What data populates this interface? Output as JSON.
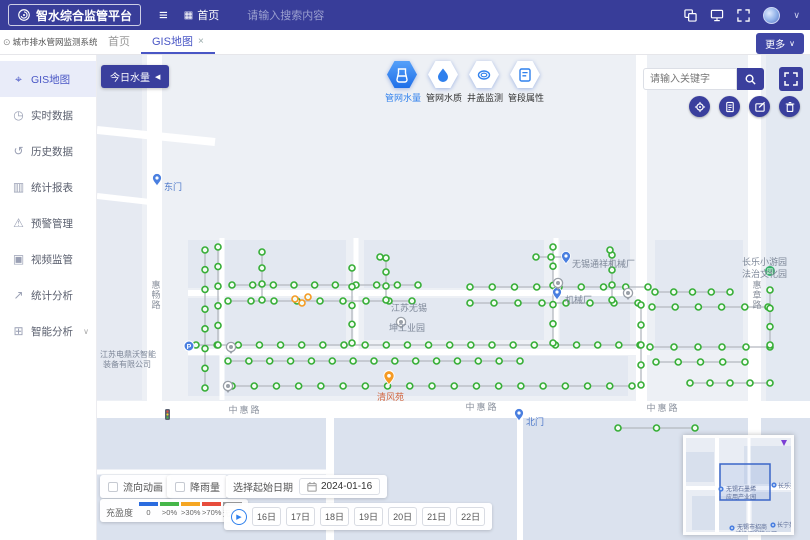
{
  "colors": {
    "header_bg": "#383d99",
    "indigo": "#3a3f9d",
    "accent_blue": "#2f80ed",
    "node_green": "#36ae36",
    "orange": "#f59a23",
    "road_label": "#8b929e"
  },
  "icons": {
    "hamburger": "≡",
    "home_grid": "▦",
    "chevron_down": "∨",
    "collapse_up": "^",
    "close": "×",
    "play": "▶",
    "back_arrow": "◀",
    "info": "⊙",
    "expand_down": "∨"
  },
  "header": {
    "logo_text": "智水综合监管平台",
    "home_label": "首页",
    "search_placeholder": "请输入搜索内容"
  },
  "tabbar": {
    "system_title": "城市排水管网监测系统",
    "tabs": [
      {
        "label": "首页",
        "active": false,
        "closable": false
      },
      {
        "label": "GIS地图",
        "active": true,
        "closable": true
      }
    ],
    "more_label": "更多"
  },
  "sidebar": {
    "items": [
      {
        "glyph": "⌖",
        "icon": "gis-map-icon",
        "label": "GIS地图",
        "active": true
      },
      {
        "glyph": "◷",
        "icon": "clock-icon",
        "label": "实时数据"
      },
      {
        "glyph": "↺",
        "icon": "history-icon",
        "label": "历史数据"
      },
      {
        "glyph": "▥",
        "icon": "report-icon",
        "label": "统计报表"
      },
      {
        "glyph": "⚠",
        "icon": "alert-icon",
        "label": "预警管理"
      },
      {
        "glyph": "▣",
        "icon": "video-icon",
        "label": "视频监管"
      },
      {
        "glyph": "↗",
        "icon": "trend-icon",
        "label": "统计分析"
      },
      {
        "glyph": "⊞",
        "icon": "ai-icon",
        "label": "智能分析",
        "expandable": true
      }
    ]
  },
  "map_toolbar": {
    "today_button": "今日水量",
    "layers": [
      {
        "icon": "beaker",
        "label": "管网水量",
        "active": true
      },
      {
        "icon": "droplet",
        "label": "管网水质",
        "active": false
      },
      {
        "icon": "manhole",
        "label": "井盖监测",
        "active": false
      },
      {
        "icon": "card",
        "label": "管段属性",
        "active": false
      }
    ],
    "keyword_placeholder": "请输入关键字",
    "actions": [
      {
        "icon": "locate",
        "name": "locate-button"
      },
      {
        "icon": "report",
        "name": "report-button"
      },
      {
        "icon": "edit",
        "name": "edit-button"
      },
      {
        "icon": "trash",
        "name": "delete-button"
      }
    ]
  },
  "map": {
    "road_labels": [
      {
        "text": "中惠路",
        "x": 245,
        "y": 413
      },
      {
        "text": "中惠路",
        "x": 482,
        "y": 410
      },
      {
        "text": "中惠路",
        "x": 663,
        "y": 411
      },
      {
        "text": "惠畅路",
        "x": 156,
        "y": 288,
        "vertical": true
      },
      {
        "text": "惠章路",
        "x": 757,
        "y": 288,
        "vertical": true
      }
    ],
    "poi_labels": [
      {
        "text": "无锡通祥机械厂",
        "x": 572,
        "y": 267,
        "size": 9
      },
      {
        "text": "机械厂",
        "x": 565,
        "y": 303,
        "size": 9
      },
      {
        "text": "江苏无锡",
        "x": 391,
        "y": 311,
        "size": 9
      },
      {
        "text": "坤工业园",
        "x": 389,
        "y": 331,
        "size": 9
      },
      {
        "text": "长乐小游园",
        "x": 742,
        "y": 265,
        "size": 9
      },
      {
        "text": "法治文化园",
        "x": 742,
        "y": 277,
        "size": 9
      },
      {
        "text": "江苏电鼎沃智能",
        "x": 100,
        "y": 357,
        "size": 8
      },
      {
        "text": "装备有限公司",
        "x": 103,
        "y": 367,
        "size": 8
      },
      {
        "text": "清风苑",
        "x": 377,
        "y": 400,
        "size": 9,
        "color": "#d2653f"
      },
      {
        "text": "东门",
        "x": 164,
        "y": 190,
        "size": 9,
        "color": "#4a76c9"
      },
      {
        "text": "北门",
        "x": 526,
        "y": 425,
        "size": 9,
        "color": "#4a76c9"
      }
    ],
    "pins": [
      {
        "type": "blue",
        "x": 157,
        "y": 186
      },
      {
        "type": "blue",
        "x": 519,
        "y": 421
      },
      {
        "type": "blue",
        "x": 566,
        "y": 264
      },
      {
        "type": "blue",
        "x": 557,
        "y": 300
      },
      {
        "type": "green",
        "x": 770,
        "y": 271
      },
      {
        "type": "circle-p",
        "x": 189,
        "y": 346
      },
      {
        "type": "orange",
        "x": 389,
        "y": 385
      },
      {
        "type": "camera",
        "x": 231,
        "y": 347
      },
      {
        "type": "camera",
        "x": 228,
        "y": 386
      },
      {
        "type": "camera",
        "x": 558,
        "y": 283
      },
      {
        "type": "camera",
        "x": 628,
        "y": 293
      },
      {
        "type": "camera",
        "x": 401,
        "y": 322
      }
    ],
    "network": {
      "segments": [
        {
          "x1": 536,
          "y1": 257,
          "x2": 566,
          "y2": 257,
          "n": 3
        },
        {
          "x1": 232,
          "y1": 285,
          "x2": 418,
          "y2": 285,
          "n": 10
        },
        {
          "x1": 470,
          "y1": 287,
          "x2": 648,
          "y2": 287,
          "n": 9
        },
        {
          "x1": 228,
          "y1": 301,
          "x2": 412,
          "y2": 301,
          "n": 9
        },
        {
          "x1": 470,
          "y1": 303,
          "x2": 638,
          "y2": 303,
          "n": 8
        },
        {
          "x1": 196,
          "y1": 345,
          "x2": 640,
          "y2": 345,
          "n": 22
        },
        {
          "x1": 228,
          "y1": 361,
          "x2": 520,
          "y2": 361,
          "n": 15
        },
        {
          "x1": 232,
          "y1": 386,
          "x2": 632,
          "y2": 386,
          "n": 19
        },
        {
          "x1": 655,
          "y1": 292,
          "x2": 730,
          "y2": 292,
          "n": 5
        },
        {
          "x1": 652,
          "y1": 307,
          "x2": 768,
          "y2": 307,
          "n": 6
        },
        {
          "x1": 650,
          "y1": 347,
          "x2": 770,
          "y2": 347,
          "n": 6
        },
        {
          "x1": 656,
          "y1": 362,
          "x2": 745,
          "y2": 362,
          "n": 5
        },
        {
          "x1": 690,
          "y1": 383,
          "x2": 770,
          "y2": 383,
          "n": 5
        },
        {
          "x1": 618,
          "y1": 428,
          "x2": 695,
          "y2": 428,
          "n": 3
        },
        {
          "x1": 205,
          "y1": 250,
          "x2": 205,
          "y2": 388,
          "n": 8
        },
        {
          "x1": 218,
          "y1": 247,
          "x2": 218,
          "y2": 345,
          "n": 6
        },
        {
          "x1": 262,
          "y1": 252,
          "x2": 262,
          "y2": 300,
          "n": 4
        },
        {
          "x1": 352,
          "y1": 268,
          "x2": 352,
          "y2": 343,
          "n": 5
        },
        {
          "x1": 386,
          "y1": 258,
          "x2": 386,
          "y2": 300,
          "n": 4
        },
        {
          "x1": 553,
          "y1": 247,
          "x2": 553,
          "y2": 343,
          "n": 6
        },
        {
          "x1": 612,
          "y1": 255,
          "x2": 612,
          "y2": 300,
          "n": 4
        },
        {
          "x1": 641,
          "y1": 305,
          "x2": 641,
          "y2": 385,
          "n": 5
        },
        {
          "x1": 770,
          "y1": 290,
          "x2": 770,
          "y2": 345,
          "n": 4
        }
      ],
      "extra_nodes": [
        {
          "x": 380,
          "y": 257
        },
        {
          "x": 610,
          "y": 250
        }
      ],
      "orange_nodes": [
        {
          "x": 295,
          "y": 299
        },
        {
          "x": 302,
          "y": 303
        },
        {
          "x": 308,
          "y": 297
        }
      ]
    }
  },
  "bottom": {
    "flow_checkbox": "流向动画",
    "rain_checkbox": "降雨量",
    "legend_title": "充盈度",
    "legend_items": [
      {
        "label": "0",
        "color": "#2b6cdf"
      },
      {
        "label": ">0%",
        "color": "#45b649"
      },
      {
        "label": ">30%",
        "color": "#f5a623"
      },
      {
        "label": ">70%",
        "color": "#e74c3c"
      },
      {
        "label": "无数据",
        "color": "#9b9b9b"
      }
    ],
    "date_label": "选择起始日期",
    "date_value": "2024-01-16",
    "dates": [
      "16日",
      "17日",
      "18日",
      "19日",
      "20日",
      "21日",
      "22日"
    ]
  },
  "minimap": {
    "labels": [
      {
        "text": "无锡石墨烯",
        "x": 40,
        "y": 53
      },
      {
        "text": "应用产业园",
        "x": 40,
        "y": 61
      },
      {
        "text": "长乐苑",
        "x": 92,
        "y": 50
      },
      {
        "text": "无锡市招商",
        "x": 51,
        "y": 91
      },
      {
        "text": "城纺织服装公司",
        "x": 49,
        "y": 98
      },
      {
        "text": "长宁苑",
        "x": 91,
        "y": 89
      }
    ],
    "pins": [
      {
        "x": 35,
        "y": 51
      },
      {
        "x": 88,
        "y": 47
      },
      {
        "x": 46,
        "y": 90
      },
      {
        "x": 87,
        "y": 87
      }
    ]
  }
}
